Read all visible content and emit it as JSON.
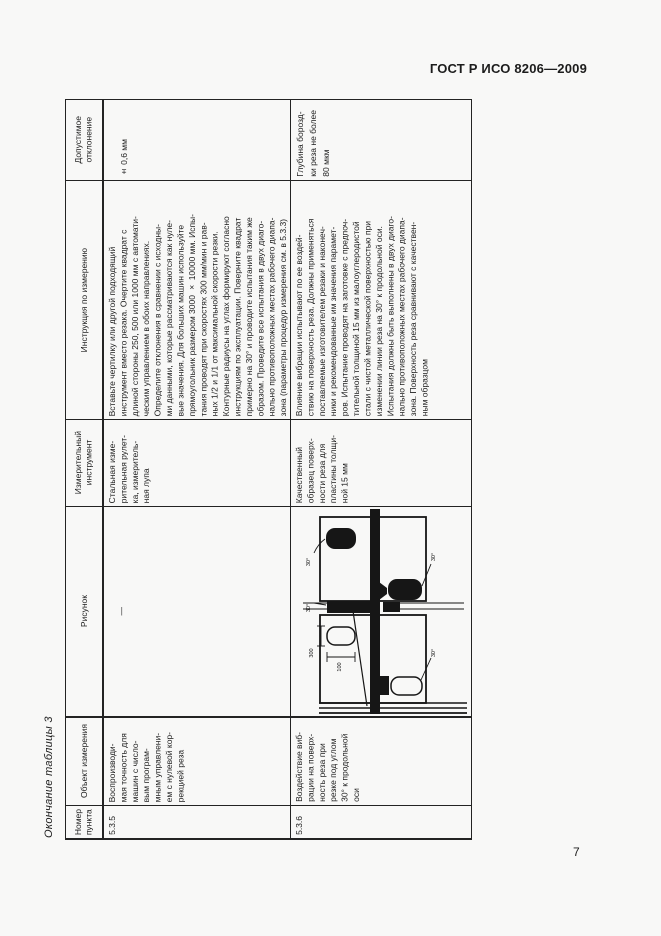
{
  "page": {
    "header_title": "ГОСТ Р ИСО 8206—2009",
    "table_caption": "Окончание таблицы 3",
    "page_number": "7"
  },
  "table": {
    "headers": {
      "item": "Номер\nпункта",
      "object": "Объект измерения",
      "figure": "Рисунок",
      "tool": "Измерительный\nинструмент",
      "instruction": "Инструкция по измерению",
      "tolerance": "Допустимое\nотклонение"
    },
    "rows": [
      {
        "item": "5.3.5",
        "object": "Воспроизводи-\nмая точность для\nмашин с число-\nвым програм-\nмным управлени-\nем с нулевой кор-\nрекцией реза",
        "figure": "—",
        "tool": "Стальная изме-\nрительная рулет-\nка, измеритель-\nная лупа",
        "instruction": "Вставьте чертилку или другой подходящий\nинструмент вместо резака. Очертите квадрат с\nдлиной стороны 250, 500 или 1000 мм с автомати-\nческим управлением в обоих направлениях.\nОпределите отклонения в сравнении с исходны-\nми данными, которые рассматриваются как нуле-\nвые значения. Для больших машин используйте\nпрямоугольник размером 3000 × 10000 мм. Испы-\nтания проводят при скоростях 300 мм/мин и рав-\nных 1/2 и 1/1 от максимальной скорости резки.\nКонтурные радиусы на углах формируют согласно\nинструкциям по эксплуатации. Поверните квадрат\nпримерно на 30° и проводите испытания таким же\nобразом. Проведите все испытания в двух диаго-\nнально противоположных местах рабочего диапа-\nзона (параметры процедур измерения см. в 5.3.3)",
        "tolerance": "± 0,6 мм"
      },
      {
        "item": "5.3.6",
        "object": "Воздействие виб-\nрации на поверх-\nность реза при\nрезке под углом\n30° к продольной\nоси",
        "tool": "Качественный\nобразец поверх-\nности реза для\nпластины толщи-\nной 15 мм",
        "instruction": "Влияние вибрации испытывают по ее воздей-\nствию на поверхность реза. Должны применяться\nпоставляемые изготовителем резаки и наконеч-\nники и рекомендованные им значения парамет-\nров. Испытание проводят на заготовке с предпоч-\nтительной толщиной 15 мм из малоуглеродистой\nстали с чистой металлической поверхностью при\nизменении линии реза на 30° к продольной оси.\nИспытания должны быть выполнены в двух диаго-\nнально противоположных местах рабочего диапа-\nзона. Поверхность реза сравнивают с качествен-\nным образцом",
        "tolerance": "Глубина борозд-\nки реза не более\n80 мкм"
      }
    ]
  },
  "figure": {
    "labels": {
      "angle": "30°",
      "dim_length": "300",
      "dim_width": "100"
    }
  }
}
